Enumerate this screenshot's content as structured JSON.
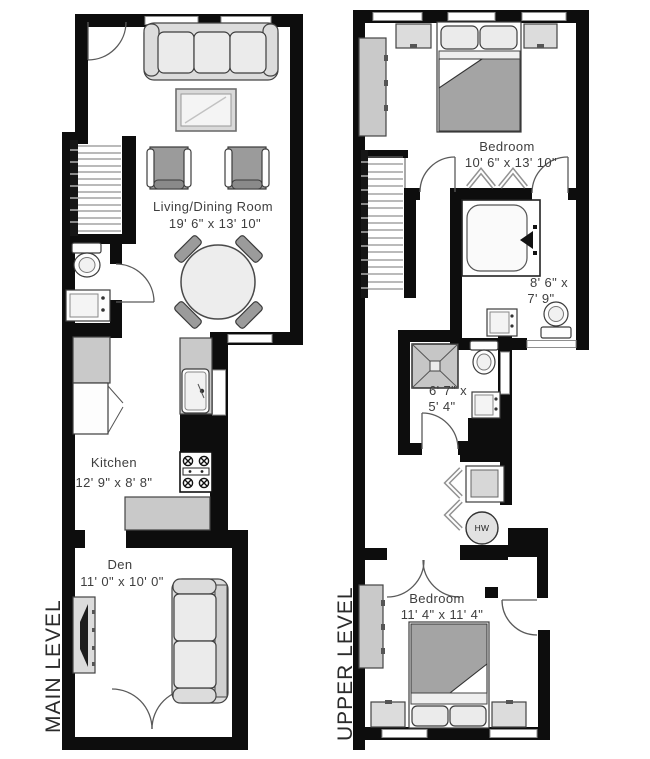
{
  "palette": {
    "wall": "#0d0d0d",
    "background": "#ffffff",
    "furniture_light": "#dcdcdc",
    "furniture_mid": "#c9c9c9",
    "furniture_dark": "#9b9b9b",
    "bed_blanket": "#a4a4a4",
    "text": "#3e3e3e"
  },
  "main_level": {
    "label": "MAIN LEVEL",
    "living_dining": {
      "name": "Living/Dining Room",
      "dims": "19' 6\" x 13' 10\""
    },
    "kitchen": {
      "name": "Kitchen",
      "dims": "12' 9\" x 8' 8\""
    },
    "den": {
      "name": "Den",
      "dims": "11' 0\" x 10' 0\""
    }
  },
  "upper_level": {
    "label": "UPPER LEVEL",
    "bedroom_front": {
      "name": "Bedroom",
      "dims": "10' 6\" x 13' 10\""
    },
    "bathroom": {
      "dims_line1": "8' 6\" x",
      "dims_line2": "7' 9\""
    },
    "half_bath": {
      "dims_line1": "6' 7\" x",
      "dims_line2": "5' 4\""
    },
    "bedroom_back": {
      "name": "Bedroom",
      "dims": "11' 4\" x 11' 4\""
    },
    "water_heater": {
      "label": "HW"
    }
  }
}
